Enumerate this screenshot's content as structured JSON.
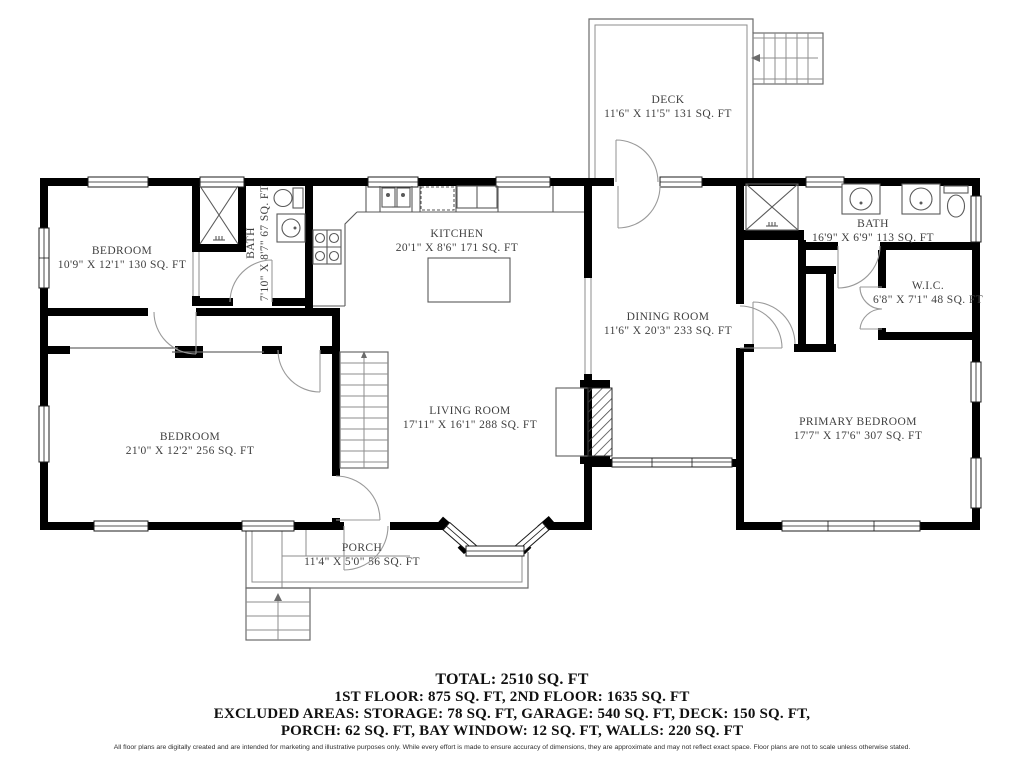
{
  "rooms": {
    "deck": {
      "label": "DECK",
      "dims": "11'6\" X 11'5\" 131 SQ. FT"
    },
    "bedroom_top": {
      "label": "BEDROOM",
      "dims": "10'9\" X 12'1\" 130 SQ. FT"
    },
    "bath_small": {
      "label": "BATH",
      "dims": "7'10\" X 8'7\" 67 SQ. FT"
    },
    "kitchen": {
      "label": "KITCHEN",
      "dims": "20'1\" X 8'6\" 171 SQ. FT"
    },
    "dining_room": {
      "label": "DINING ROOM",
      "dims": "11'6\" X 20'3\" 233 SQ. FT"
    },
    "bath_primary": {
      "label": "BATH",
      "dims": "16'9\" X 6'9\" 113 SQ. FT"
    },
    "wic": {
      "label": "W.I.C.",
      "dims": "6'8\" X 7'1\" 48 SQ. FT"
    },
    "living_room": {
      "label": "LIVING ROOM",
      "dims": "17'11\" X 16'1\" 288 SQ. FT"
    },
    "bedroom_large": {
      "label": "BEDROOM",
      "dims": "21'0\" X 12'2\" 256 SQ. FT"
    },
    "primary_bedroom": {
      "label": "PRIMARY BEDROOM",
      "dims": "17'7\" X 17'6\" 307 SQ. FT"
    },
    "porch": {
      "label": "PORCH",
      "dims": "11'4\" X 5'0\" 56 SQ. FT"
    }
  },
  "summary": {
    "total": "TOTAL: 2510 SQ. FT",
    "floors": "1ST FLOOR: 875 SQ. FT, 2ND FLOOR: 1635 SQ. FT",
    "excluded_1": "EXCLUDED AREAS: STORAGE: 78 SQ. FT, GARAGE: 540 SQ. FT, DECK: 150 SQ. FT,",
    "excluded_2": "PORCH: 62 SQ. FT, BAY WINDOW: 12 SQ. FT, WALLS: 220 SQ. FT"
  },
  "disclaimer": "All floor plans are digitally created and are intended for marketing and illustrative purposes only. While every effort is made to ensure accuracy of dimensions, they are approximate and may not reflect exact space. Floor plans are not to scale unless otherwise stated.",
  "colors": {
    "wall": "#000000",
    "thin_line": "#6b6b6b",
    "label_text": "#3f3f3f",
    "summary_text": "#101010"
  }
}
